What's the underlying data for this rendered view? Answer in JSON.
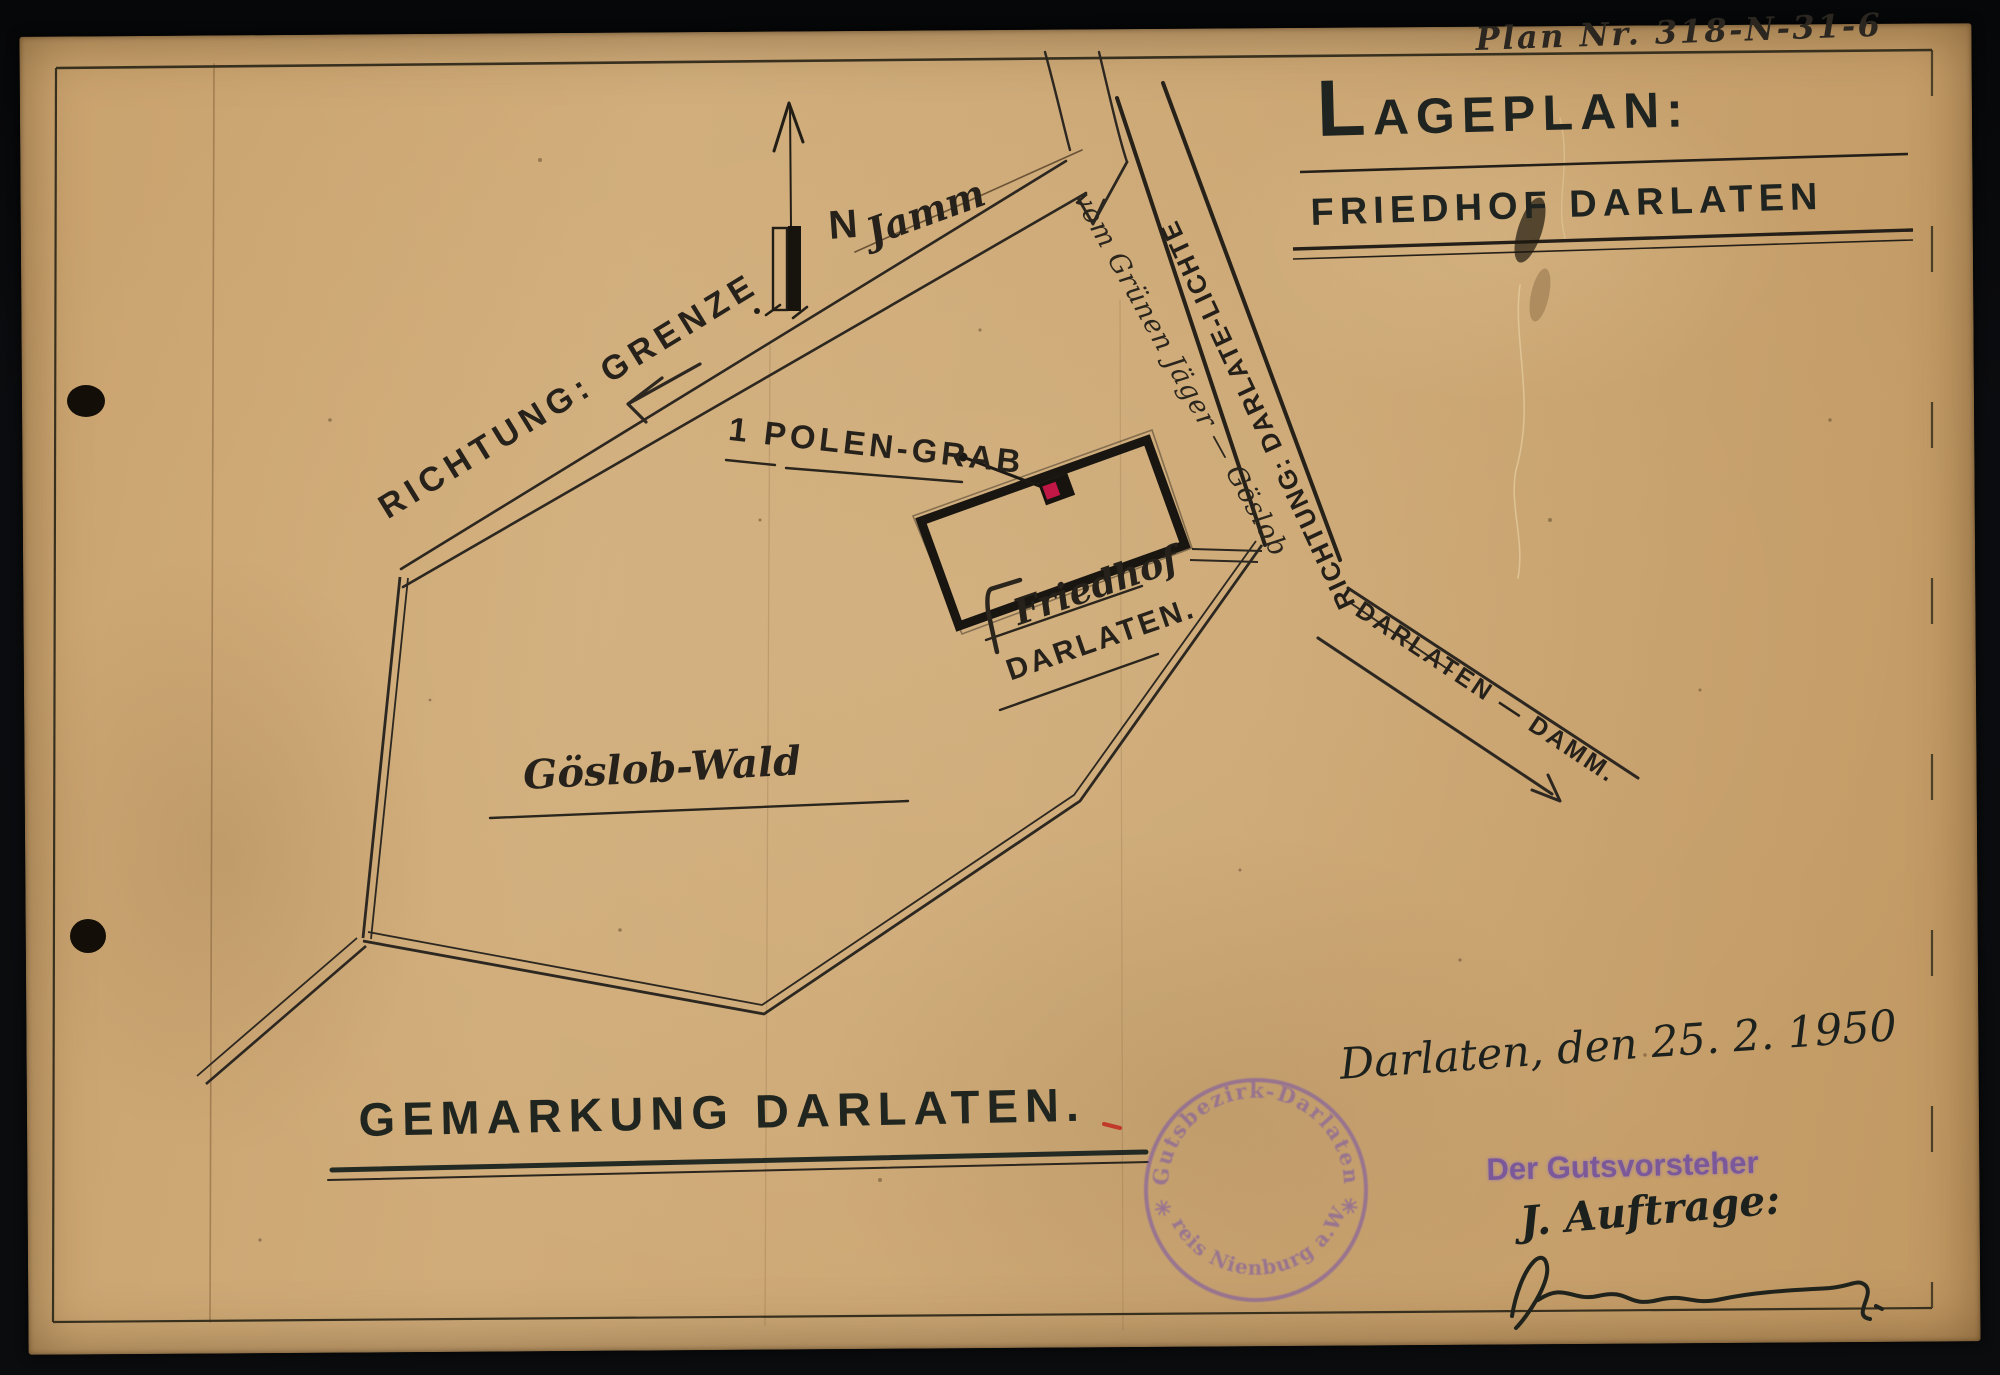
{
  "document": {
    "plan_number": "Plan Nr. 318-N-31-6",
    "title_line1": "LAGEPLAN:",
    "title_line2": "FRIEDHOF DARLATEN"
  },
  "map": {
    "north_letter": "N",
    "north_place": "Jamm",
    "direction_grenze": "RICHTUNG: GRENZE",
    "road_gruener_jaeger": "vom Grünen Jäger — Göslob",
    "direction_darlate_lichte": "RICHTUNG: DARLATE-LICHTE",
    "polen_grab": "1 POLEN-GRAB",
    "friedhof_label_line1": "Friedhof",
    "friedhof_label_line2": "DARLATEN.",
    "forest_label": "Göslob-Wald",
    "damm_road": "DARLATEN — DAMM.",
    "gemarkung": "GEMARKUNG DARLATEN."
  },
  "footer": {
    "date_line": "Darlaten, den 25. 2. 1950",
    "stamp_circle_top": "✳ Gutsbezirk-Darlaten ✳",
    "stamp_circle_bottom": "Kreis Nienburg a.W.",
    "stamp_title": "Der Gutsvorsteher",
    "auftrag_line": "J. Auftrage:"
  },
  "colors": {
    "paper": "#cfa873",
    "ink": "#26221b",
    "stamp_purple": "#7a56a8",
    "grave_red": "#c01746",
    "background": "#0a0b0d"
  }
}
